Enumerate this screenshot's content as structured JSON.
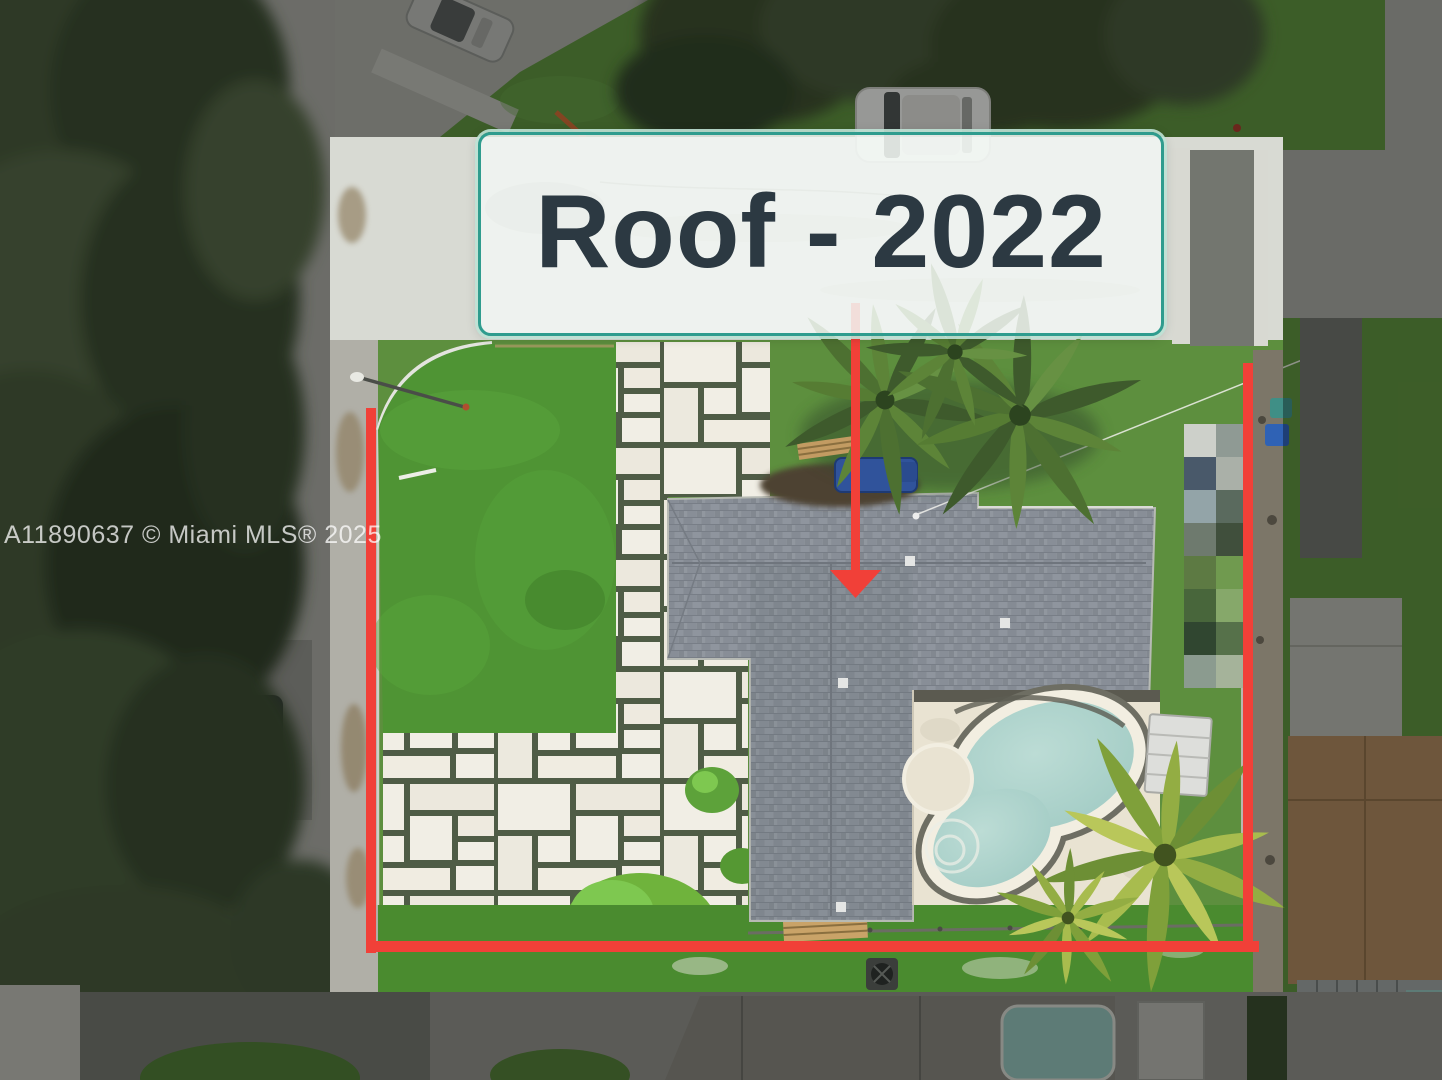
{
  "annotation": {
    "label_text": "Roof - 2022",
    "text_color": "#2c3942",
    "border_color": "#2f9c8e",
    "border_glow": "rgba(191,227,214,0.9)",
    "background": "rgba(241,246,242,0.87)",
    "accent_red": "#f14038"
  },
  "watermark": {
    "text": "A11890637 © Miami MLS® 2025",
    "color": "rgba(255,255,255,0.74)"
  },
  "scene_colors": {
    "roof_shingle": "#8a9098",
    "pool_water": "#a3ccc5",
    "pool_deck": "#e9e3d2",
    "lawn_green": "#4f9434",
    "paver_light": "#f1eee5",
    "paver_grout": "#4f5c46",
    "road_bright": "#d8dad3",
    "dim_overlay": "rgba(0,0,0,0.35)"
  }
}
